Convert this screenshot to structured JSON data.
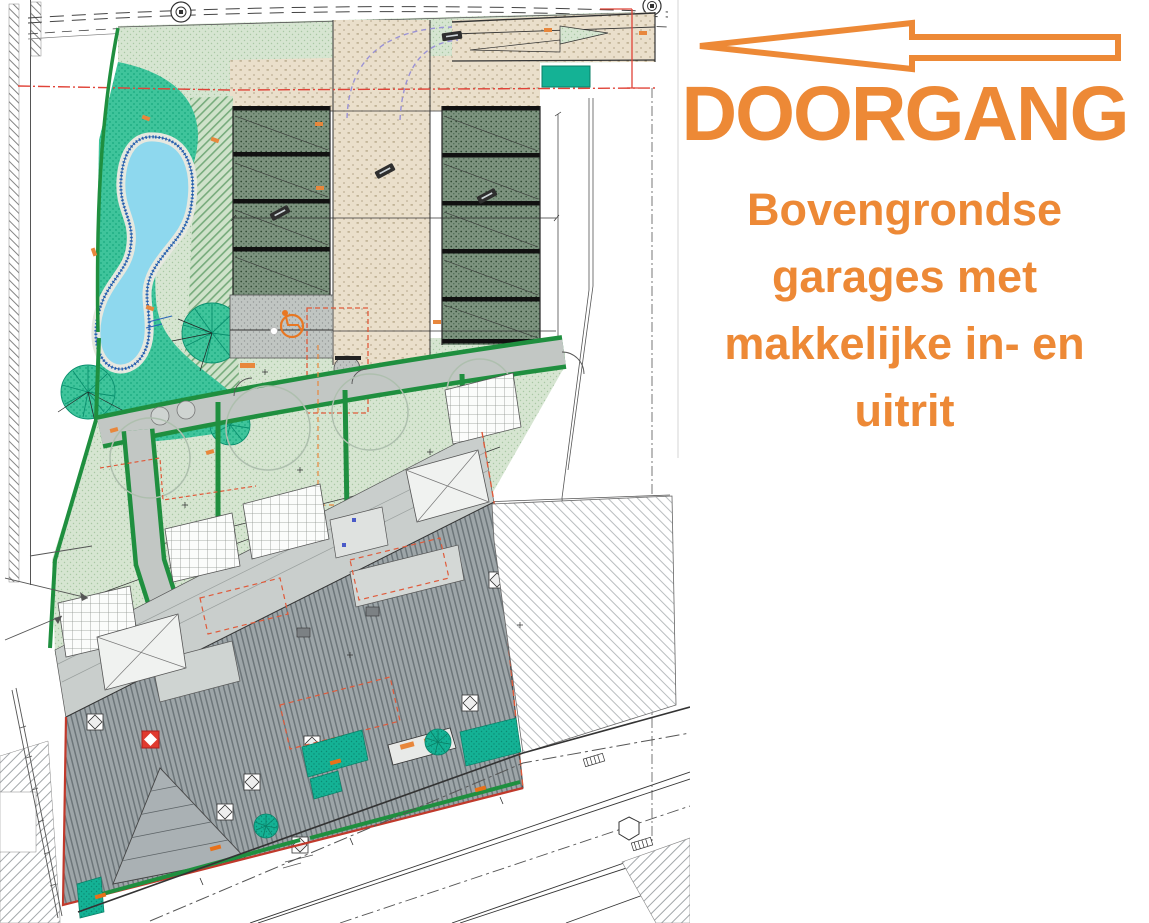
{
  "annotation": {
    "heading": "DOORGANG",
    "subtitle_lines": [
      "Bovengrondse",
      "garages met",
      "makkelijke in- en",
      "uitrit"
    ],
    "accent_color": "#ED8936",
    "arrow_direction": "left"
  },
  "plan": {
    "type": "architectural-site-plan",
    "features": {
      "pool": "swimming-pool",
      "garages": "above-ground-garage-boxes",
      "driveway": "central-driveway",
      "disabled_parking": "wheelchair-parking-spot",
      "street": "street-with-axis-line",
      "buildings": "row-houses-with-hatched-roofs"
    },
    "colors": {
      "lawn": "#D6E5D1",
      "vegetation": "#3FC49B",
      "pool_water": "#8ED8EE",
      "pool_edge": "#2A63B8",
      "hedge": "#1F8F3F",
      "driveway_beige": "#EADFCB",
      "parking_stall": "#7D937F",
      "roof_gray": "#9DA5A8",
      "teal_planting": "#14B295",
      "boundary_red": "#E04338",
      "utility_orange": "#E8873C",
      "turning_curve_purple": "#9A92D6"
    }
  }
}
